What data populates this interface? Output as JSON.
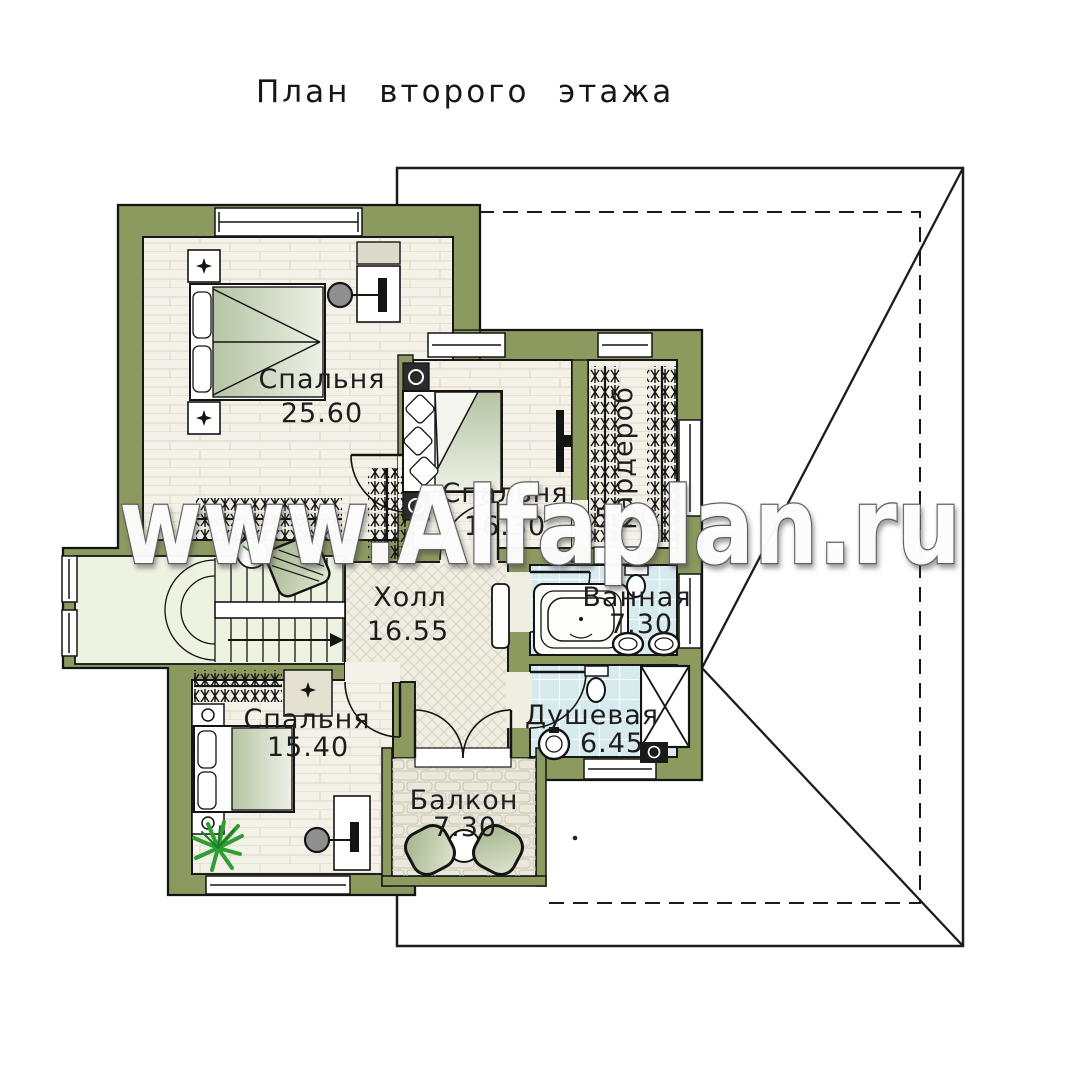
{
  "title": "План второго этажа",
  "watermark": "www.Alfaplan.ru",
  "rooms": [
    {
      "id": "bedroom-master",
      "name": "Спальня",
      "area": "25.60"
    },
    {
      "id": "bedroom-middle",
      "name": "Спальня",
      "area": "16.30"
    },
    {
      "id": "wardrobe",
      "name": "Гардероб",
      "area": "5.20"
    },
    {
      "id": "hall",
      "name": "Холл",
      "area": "16.55"
    },
    {
      "id": "bathroom",
      "name": "Ванная",
      "area": "7.30"
    },
    {
      "id": "shower",
      "name": "Душевая",
      "area": "6.45"
    },
    {
      "id": "bedroom-small",
      "name": "Спальня",
      "area": "15.40"
    },
    {
      "id": "balcony",
      "name": "Балкон",
      "area": "7.30"
    }
  ],
  "colors": {
    "wall_olive": "#8c9a60",
    "floor_wood": "#f3f1e8",
    "floor_hall": "#f0eee3",
    "floor_tile": "#d7ebee",
    "floor_stone": "#eae8db",
    "floor_stairs": "#eef2e1",
    "outline": "#141414",
    "plant_green": "#2f9e33",
    "watermark_fill": "#ffffff",
    "watermark_outline": "#5e5e5e"
  }
}
